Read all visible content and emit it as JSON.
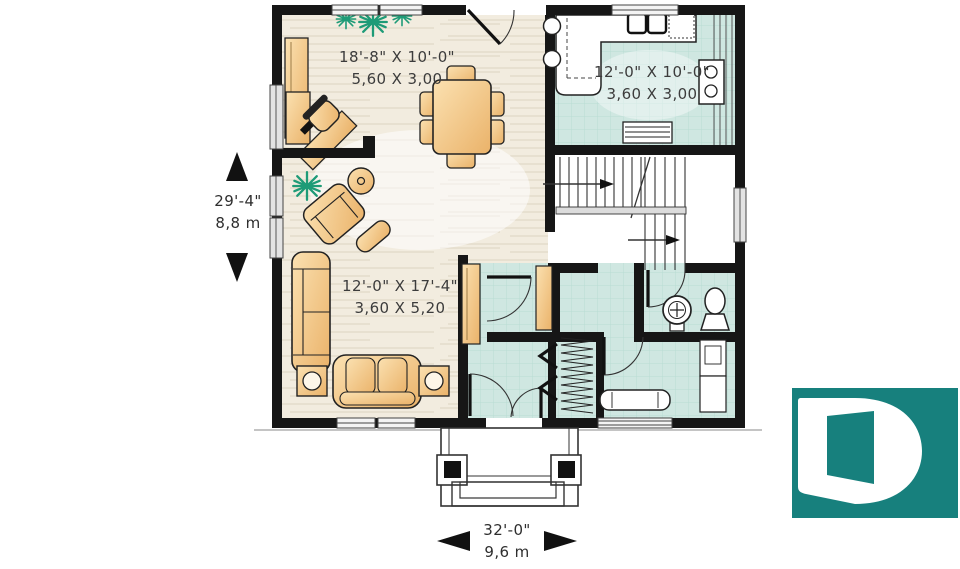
{
  "rooms": {
    "dining": {
      "imperial": "18'-8\" X 10'-0\"",
      "metric": "5,60 X 3,00"
    },
    "kitchen": {
      "imperial": "12'-0\" X 10'-0\"",
      "metric": "3,60 X 3,00"
    },
    "living": {
      "imperial": "12'-0\" X 17'-4\"",
      "metric": "3,60 X 5,20"
    }
  },
  "dimensions": {
    "depth": {
      "imperial": "29'-4\"",
      "metric": "8,8 m"
    },
    "width": {
      "imperial": "32'-0\"",
      "metric": "9,6 m"
    }
  },
  "logo": {
    "letter": "D",
    "background": "#17807d",
    "letter_color": "#ffffff"
  },
  "colors": {
    "wall": "#161616",
    "wood_floor": "#f2ecdf",
    "tile_floor": "#cfe7e1",
    "furniture": "#f2c07c",
    "plant": "#1e9b77"
  }
}
